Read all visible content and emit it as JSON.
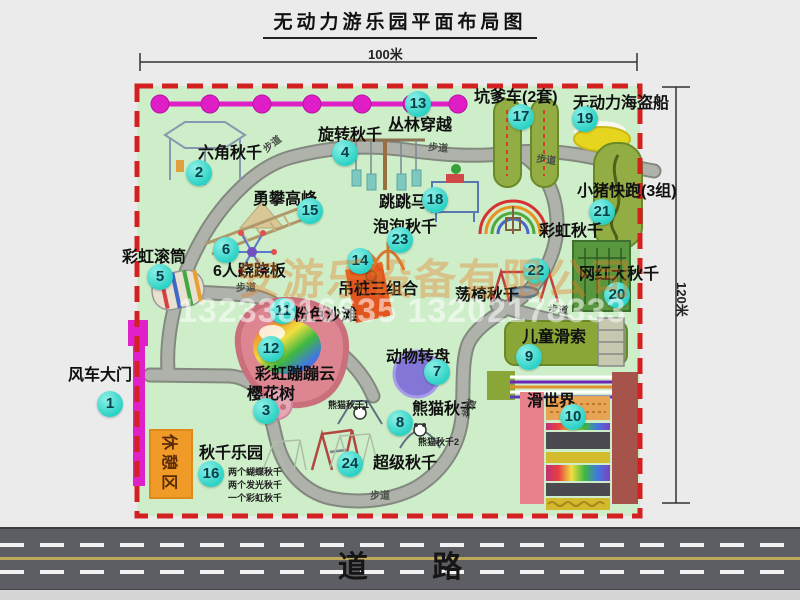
{
  "title": "无动力游乐园平面布局图",
  "dimensions": {
    "top": "100米",
    "right": "120米"
  },
  "road": {
    "label": "道 路"
  },
  "watermark": {
    "company": "安游乐设备有限公司",
    "phones": "13233816635 13202178333"
  },
  "rest_area": {
    "label": "休憩区"
  },
  "colors": {
    "park_fill": "#cdeec8",
    "border_red": "#d32020",
    "path_gray": "#aeb2aa",
    "marker_teal": "#2cd2c6",
    "gate_magenta": "#e020c8",
    "rest_orange": "#f09a28",
    "road_gray": "#5d5d64",
    "track_olive": "#93ad45",
    "beach_pink": "#dd8692"
  },
  "facilities": [
    {
      "id": "windmill-gate",
      "num": "1",
      "label": "风车大门",
      "lx": 68,
      "ly": 368,
      "cx": 110,
      "cy": 404
    },
    {
      "id": "hexagon-swing",
      "num": "2",
      "label": "六角秋千",
      "lx": 198,
      "ly": 146,
      "cx": 199,
      "cy": 173
    },
    {
      "id": "cherry-tree",
      "num": "3",
      "label": "樱花树",
      "lx": 247,
      "ly": 387,
      "cx": 266,
      "cy": 411
    },
    {
      "id": "rotating-swing",
      "num": "4",
      "label": "旋转秋千",
      "lx": 318,
      "ly": 128,
      "cx": 345,
      "cy": 153
    },
    {
      "id": "rainbow-roller",
      "num": "5",
      "label": "彩虹滚筒",
      "lx": 122,
      "ly": 250,
      "cx": 160,
      "cy": 277
    },
    {
      "id": "six-seesaw",
      "num": "6",
      "label": "6人跷跷板",
      "lx": 213,
      "ly": 264,
      "cx": 226,
      "cy": 250
    },
    {
      "id": "animal-turntable",
      "num": "7",
      "label": "动物转盘",
      "lx": 386,
      "ly": 350,
      "cx": 437,
      "cy": 372
    },
    {
      "id": "panda-swing",
      "num": "8",
      "label": "熊猫秋千",
      "lx": 412,
      "ly": 402,
      "cx": 400,
      "cy": 423
    },
    {
      "id": "kids-zipline",
      "num": "9",
      "label": "儿童滑索",
      "lx": 522,
      "ly": 330,
      "cx": 529,
      "cy": 357
    },
    {
      "id": "slide-world",
      "num": "10",
      "label": "滑世界",
      "lx": 527,
      "ly": 394,
      "cx": 573,
      "cy": 417
    },
    {
      "id": "pink-beach",
      "num": "11",
      "label": "粉色沙滩",
      "lx": 293,
      "ly": 308,
      "cx": 283,
      "cy": 311
    },
    {
      "id": "rainbow-bounce-cloud",
      "num": "12",
      "label": "彩虹蹦蹦云",
      "lx": 255,
      "ly": 367,
      "cx": 271,
      "cy": 349
    },
    {
      "id": "jungle-crossing",
      "num": "13",
      "label": "丛林穿越",
      "lx": 388,
      "ly": 118,
      "cx": 418,
      "cy": 104
    },
    {
      "id": "hanging-pile-combo",
      "num": "14",
      "label": "吊桩三组合",
      "lx": 338,
      "ly": 282,
      "cx": 360,
      "cy": 261
    },
    {
      "id": "climbing-peak",
      "num": "15",
      "label": "勇攀高峰",
      "lx": 253,
      "ly": 192,
      "cx": 310,
      "cy": 211
    },
    {
      "id": "swing-park",
      "num": "16",
      "label": "秋千乐园",
      "lx": 199,
      "ly": 446,
      "cx": 211,
      "cy": 474
    },
    {
      "id": "kengdie-car",
      "num": "17",
      "label": "坑爹车(2套)",
      "lx": 474,
      "ly": 90,
      "cx": 521,
      "cy": 117
    },
    {
      "id": "jumping-horse",
      "num": "18",
      "label": "跳跳马",
      "lx": 379,
      "ly": 195,
      "cx": 435,
      "cy": 200
    },
    {
      "id": "pirate-ship",
      "num": "19",
      "label": "无动力海盗船",
      "lx": 573,
      "ly": 96,
      "cx": 585,
      "cy": 119
    },
    {
      "id": "big-swing",
      "num": "20",
      "label": "网红大秋千",
      "lx": 579,
      "ly": 267,
      "cx": 617,
      "cy": 295
    },
    {
      "id": "piggy-run",
      "num": "21",
      "label": "小猪快跑(3组)",
      "lx": 577,
      "ly": 184,
      "cx": 602,
      "cy": 212
    },
    {
      "id": "swing-chair",
      "num": "22",
      "label": "荡椅秋千",
      "lx": 455,
      "ly": 288,
      "cx": 536,
      "cy": 271
    },
    {
      "id": "bubble-swing",
      "num": "23",
      "label": "泡泡秋千",
      "lx": 373,
      "ly": 220,
      "cx": 400,
      "cy": 240
    },
    {
      "id": "super-swing",
      "num": "24",
      "label": "超级秋千",
      "lx": 373,
      "ly": 456,
      "cx": 350,
      "cy": 464
    },
    {
      "id": "rainbow-swing",
      "num": "",
      "label": "彩虹秋千",
      "lx": 539,
      "ly": 224,
      "cx": 0,
      "cy": 0
    }
  ],
  "path_labels": [
    {
      "text": "步道",
      "x": 263,
      "y": 140,
      "rot": -38
    },
    {
      "text": "步道",
      "x": 428,
      "y": 144,
      "rot": 5
    },
    {
      "text": "步道",
      "x": 536,
      "y": 156,
      "rot": 8
    },
    {
      "text": "步道",
      "x": 236,
      "y": 284,
      "rot": 0
    },
    {
      "text": "步道",
      "x": 548,
      "y": 306,
      "rot": 5
    },
    {
      "text": "步道",
      "x": 460,
      "y": 404,
      "rot": -65
    },
    {
      "text": "步道",
      "x": 370,
      "y": 492,
      "rot": 0
    }
  ],
  "sub_labels": [
    {
      "text": "熊猫秋千1",
      "x": 328,
      "y": 401
    },
    {
      "text": "熊猫秋千2",
      "x": 418,
      "y": 438
    },
    {
      "text": "两个蝴蝶秋千",
      "x": 228,
      "y": 468
    },
    {
      "text": "两个发光秋千",
      "x": 228,
      "y": 481
    },
    {
      "text": "一个彩虹秋千",
      "x": 228,
      "y": 494
    }
  ]
}
